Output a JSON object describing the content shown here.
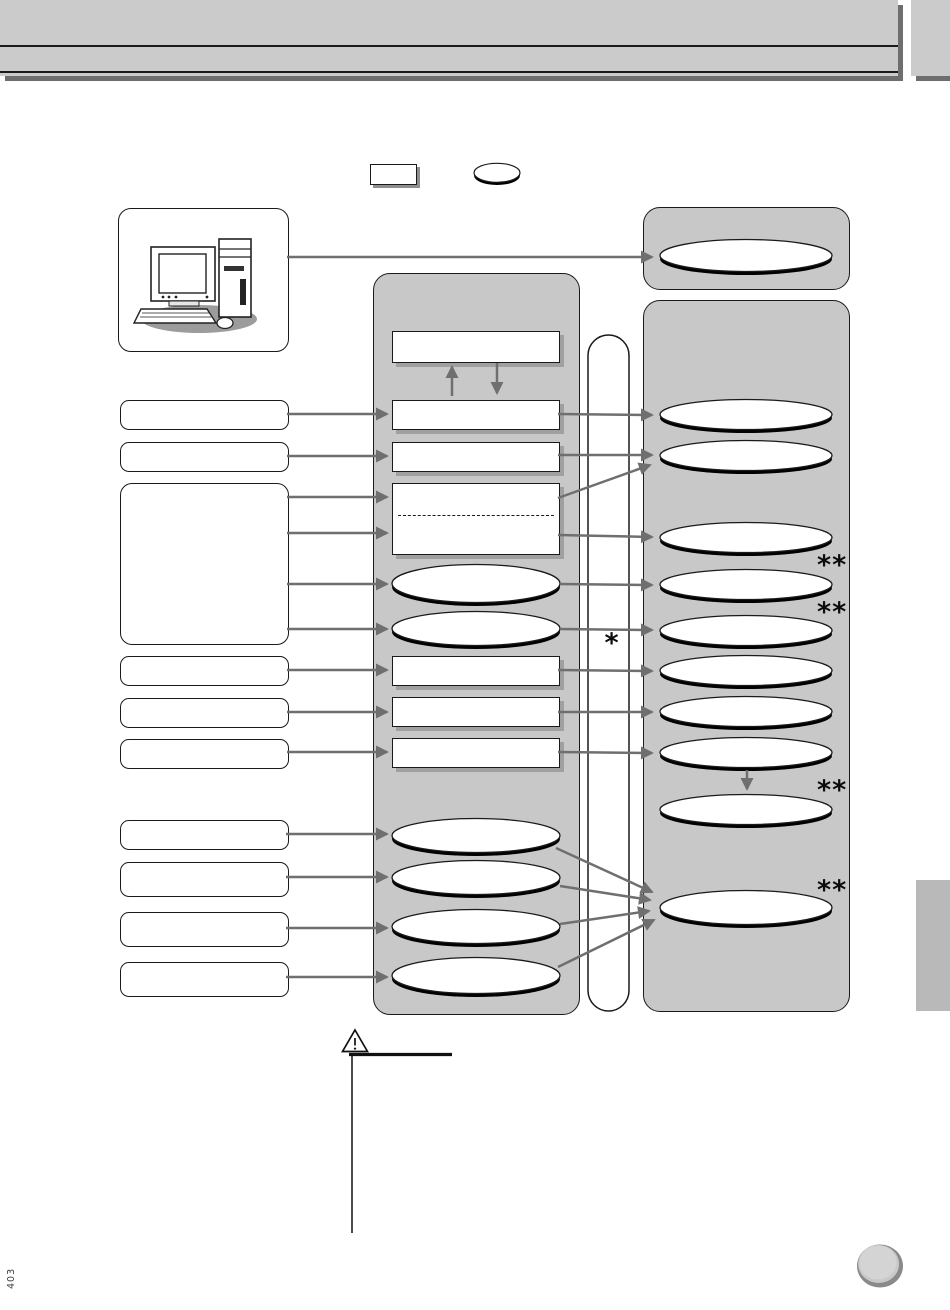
{
  "page": {
    "number": "403"
  },
  "marks": {
    "single_asterisk": "*",
    "double_asterisk": "**"
  },
  "icons": {
    "computer": "desktop-computer-illustration",
    "warning": "warning-triangle-icon",
    "nav_button": "page-nav-circle-button"
  },
  "colors": {
    "panel_gray": "#c8c8c8",
    "header_gray": "#cbcbcb",
    "drop_shadow_gray": "#6e6e6e",
    "connector_gray": "#6f6f6f",
    "box_shadow_gray": "#a0a0a0"
  }
}
